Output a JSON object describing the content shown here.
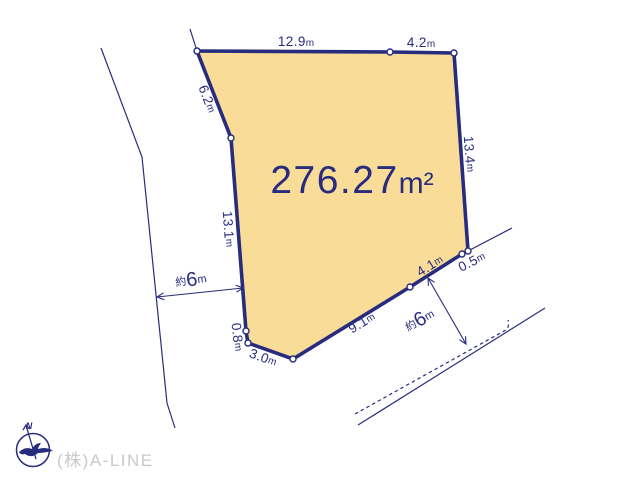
{
  "colors": {
    "navy": "#272C7E",
    "plot_fill": "#F9DC97",
    "logo_gray": "#C9C9C9",
    "bg": "#FFFFFF"
  },
  "plot": {
    "area_value": "276.27",
    "area_unit": "m²",
    "dimensions": {
      "north1": {
        "value": "12.9",
        "unit": "m"
      },
      "north2": {
        "value": "4.2",
        "unit": "m"
      },
      "northwest": {
        "value": "6.2",
        "unit": "m"
      },
      "east": {
        "value": "13.4",
        "unit": "m"
      },
      "west": {
        "value": "13.1",
        "unit": "m"
      },
      "southwest1": {
        "value": "0.8",
        "unit": "m"
      },
      "southwest2": {
        "value": "3.0",
        "unit": "m"
      },
      "south": {
        "value": "9.1",
        "unit": "m"
      },
      "southeast1": {
        "value": "4.1",
        "unit": "m"
      },
      "southeast2": {
        "value": "0.5",
        "unit": "m"
      }
    }
  },
  "roads": {
    "west_width": {
      "prefix": "約",
      "value": "6",
      "unit": "m"
    },
    "south_width": {
      "prefix": "約",
      "value": "6",
      "unit": "m"
    }
  },
  "compass": {
    "north_label": "N"
  },
  "footer": {
    "company": "(株)A-LINE"
  }
}
